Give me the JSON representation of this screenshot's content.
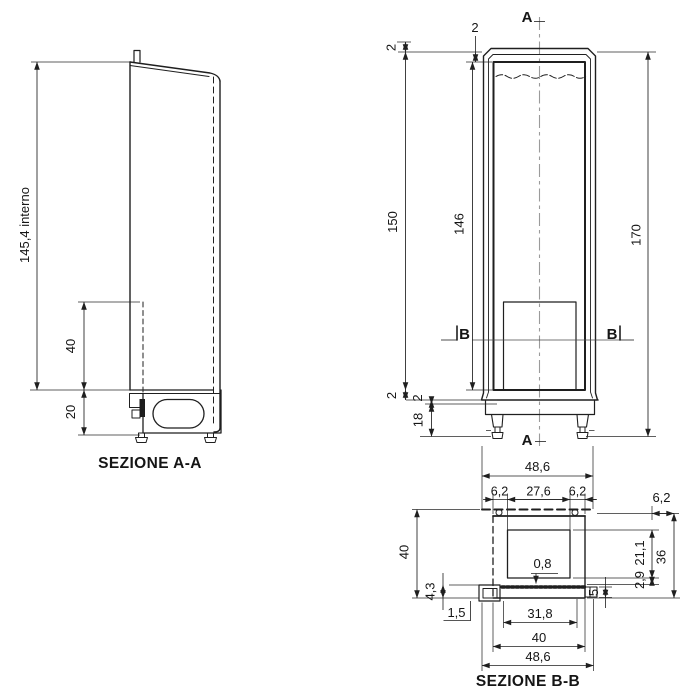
{
  "section_aa": {
    "title": "SEZIONE A-A",
    "dim_interior_height": "145,4 interno",
    "dim_compartment_height": "40",
    "dim_base_height": "20"
  },
  "front_view": {
    "section_marker_a": "A",
    "section_marker_b": "B",
    "dim_overall_height": "170",
    "dim_frame_height": "150",
    "dim_opening_height": "146",
    "dim_plinth_height": "18",
    "dim_wall_thickness": "2"
  },
  "section_bb": {
    "title": "SEZIONE B-B",
    "dim_overall_width": "48,6",
    "dim_side_wall": "6,2",
    "dim_inner_width": "27,6",
    "dim_depth": "40",
    "dim_body_width": "40",
    "dim_panel_thickness": "0,8",
    "dim_inner_depth": "21,1",
    "dim_gap": "2,9",
    "dim_overall_depth": "36",
    "dim_tab_height": "5",
    "dim_drain_height": "4,3",
    "dim_drain_wall": "1,5",
    "dim_opening_width": "31,8"
  }
}
